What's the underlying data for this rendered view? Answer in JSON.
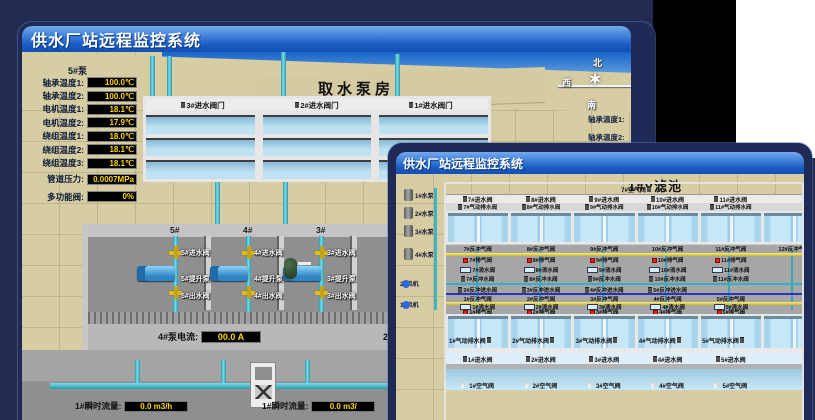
{
  "icons": {
    "compass_star": "✶",
    "list": [
      "valve-icon",
      "exhaust-valve-icon",
      "clean-water-valve-icon",
      "air-elbow-icon",
      "pump-icon",
      "blower-icon",
      "flow-meter-icon",
      "pipe-icon",
      "tank-icon",
      "compass-icon"
    ]
  },
  "colors": {
    "titlebar_top": "#74abee",
    "titlebar_bottom": "#1350b4",
    "frame": "#1d2b56",
    "desktop": "#232c50",
    "value_text": "#ffd800",
    "value_bg": "#000000",
    "pipe_teal": "#3fbccc",
    "pipe_yellow": "#e8d44a",
    "pipe_blue": "#2733c4",
    "valve_red": "#e02818",
    "valve_yellow": "#e2bc1c",
    "water": "#b9def0",
    "sand": "#d7cda3"
  },
  "intake_window": {
    "title": "供水厂站远程监控系统",
    "scene_title": "取水泵房",
    "pump_panel": {
      "pump_label": "5#泵",
      "rows": [
        {
          "label": "轴承温度1:",
          "value": "100.0℃"
        },
        {
          "label": "轴承温度2:",
          "value": "100.0℃"
        },
        {
          "label": "电机温度1:",
          "value": "18.1℃"
        },
        {
          "label": "电机温度2:",
          "value": "17.9℃"
        },
        {
          "label": "绕组温度1:",
          "value": "18.0℃"
        },
        {
          "label": "绕组温度2:",
          "value": "18.1℃"
        },
        {
          "label": "绕组温度3:",
          "value": "18.1℃"
        },
        {
          "label": "管道压力:",
          "value": "0.0007MPa"
        },
        {
          "label": "多功能阀:",
          "value": "0%"
        }
      ]
    },
    "inlet_gate_labels": [
      "3#进水阀门",
      "2#进水阀门",
      "1#进水阀门"
    ],
    "compass": {
      "north": "北",
      "west": "西",
      "south": "南"
    },
    "side_labels": [
      "轴承温度1:",
      "轴承温度2:"
    ],
    "pump_bays": [
      {
        "num": "5#",
        "inlet": "5#进水阀",
        "pump": "5#提升泵",
        "outlet": "5#出水阀"
      },
      {
        "num": "4#",
        "inlet": "4#进水阀",
        "pump": "4#提升泵",
        "outlet": "4#出水阀"
      },
      {
        "num": "3#",
        "inlet": "3#进水阀",
        "pump": "3#提升泵",
        "outlet": "3#出水阀"
      }
    ],
    "current_readouts": [
      {
        "label": "4#泵电流:",
        "value": "00.0 A"
      },
      {
        "label": "2#泵电流",
        "value": ""
      }
    ],
    "flow_readouts": [
      {
        "label": "1#瞬时流量:",
        "value": "0.0 m3/h"
      },
      {
        "label": "1#瞬时流量:",
        "value": "0.0 m3/"
      }
    ]
  },
  "filter_window": {
    "title": "供水厂站远程监控系统",
    "scene_title": "1#V滤池",
    "top_air_valves": [
      "7#空气阀",
      "8#空气阀",
      "9#空气阀",
      "10#空气阀",
      "11#空气阀",
      "12#空气阀"
    ],
    "top_inlet_valves": [
      "7#进水阀",
      "8#进水阀",
      "9#进水阀",
      "10#进水阀",
      "11#进水阀"
    ],
    "top_drain_valves": [
      "7#气动排水阀",
      "8#气动排水阀",
      "9#气动排水阀",
      "10#气动排水阀",
      "11#气动排水阀"
    ],
    "top_backwash_air_valves": [
      "7#反冲气阀",
      "8#反冲气阀",
      "9#反冲气阀",
      "10#反冲气阀",
      "11#反冲气阀",
      "12#反冲气阀"
    ],
    "top_exhaust_valves": [
      "7#排气阀",
      "8#排气阀",
      "9#排气阀",
      "10#排气阀",
      "11#排气阀"
    ],
    "top_clean_water_valves": [
      "7#清水阀",
      "8#清水阀",
      "9#清水阀",
      "10#清水阀",
      "11#清水阀"
    ],
    "top_backwash_water_valves": [
      "7#反冲水阀",
      "8#反冲水阀",
      "9#反冲水阀",
      "10#反冲水阀",
      "11#反冲水阀"
    ],
    "center_backwash_inlet_valves": [
      "2#反冲进水阀",
      "3#反冲进水阀",
      "4#反冲进水阀",
      "5#反冲进水阀"
    ],
    "bottom_backwash_air_valves": [
      "1#反冲气阀",
      "2#反冲气阀",
      "3#反冲气阀",
      "4#反冲气阀",
      "5#反冲气阀"
    ],
    "bottom_clean_water_valves": [
      "1#清水阀",
      "2#清水阀",
      "3#清水阀",
      "4#清水阀",
      "5#清水阀"
    ],
    "bottom_exhaust_valves": [
      "1#排气阀",
      "2#排气阀",
      "3#排气阀",
      "4#排气阀",
      "5#排气阀"
    ],
    "bottom_drain_valves": [
      "1#气动排水阀",
      "2#气动排水阀",
      "3#气动排水阀",
      "4#气动排水阀",
      "5#气动排水阀"
    ],
    "bottom_inlet_valves": [
      "1#进水阀",
      "2#进水阀",
      "3#进水阀",
      "4#进水阀",
      "5#进水阀"
    ],
    "bottom_air_valves": [
      "1#空气阀",
      "2#空气阀",
      "3#空气阀",
      "4#空气阀",
      "5#空气阀"
    ],
    "pumps": [
      "1#水泵",
      "2#水泵",
      "3#水泵",
      "4#水泵"
    ],
    "blowers": [
      "2#风机",
      "1#风机"
    ]
  }
}
